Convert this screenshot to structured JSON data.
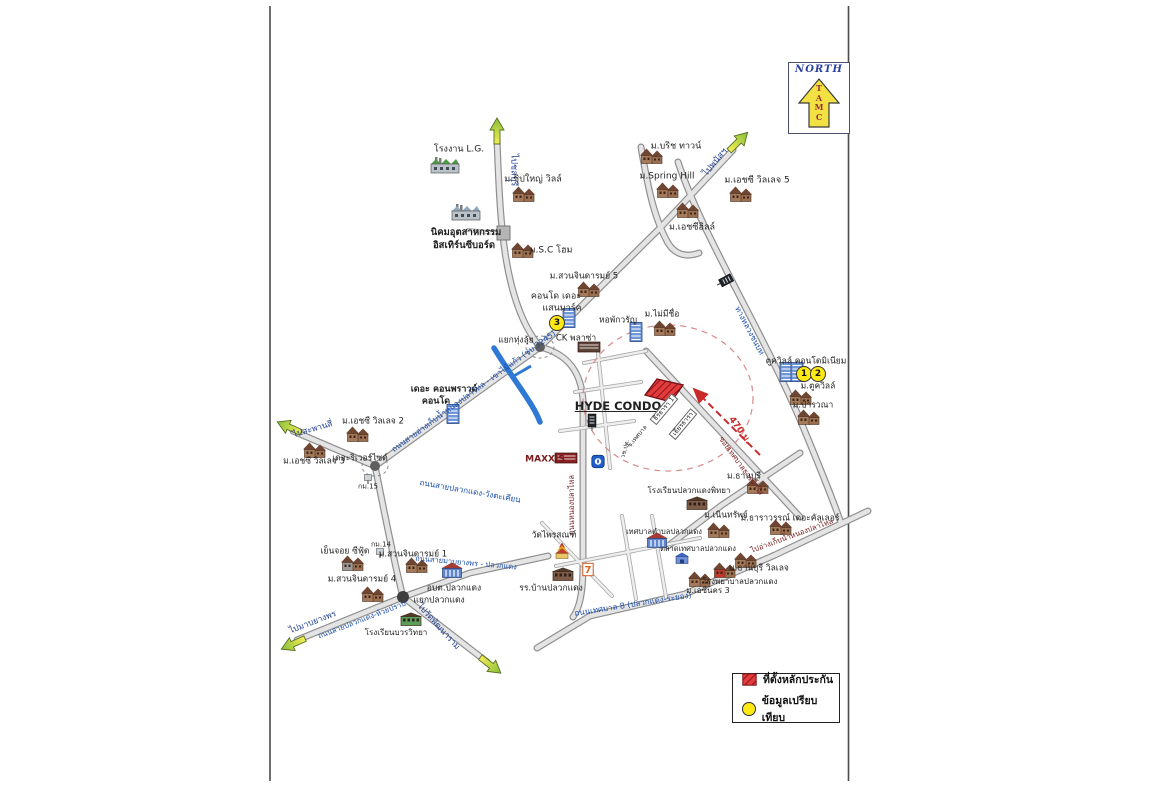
{
  "north_box": {
    "label": "NORTH",
    "letters": [
      "T",
      "A",
      "M",
      "C"
    ]
  },
  "legend": {
    "items": [
      {
        "key": "collateral-site",
        "label": "ที่ตั้งหลักประกัน"
      },
      {
        "key": "comparison-data",
        "label": "ข้อมูลเปรียบเทียบ"
      }
    ]
  },
  "colors": {
    "road_label_blue": "#1d4fae",
    "direction_navy": "#23418f",
    "distance_red": "#c92a2a",
    "soi_maroon": "#7a2020",
    "badge_yellow": "#ffe913",
    "site_hatch_red": "#e43b3b"
  },
  "map": {
    "site_name": "HYDE CONDO",
    "site_distance": "470 ม.",
    "labels": [
      {
        "text": "โรงงาน L.G.",
        "x": 459,
        "y": 150,
        "size": 9
      },
      {
        "text": "ไปชลบุรี",
        "x": 513,
        "y": 170,
        "rotate": 90,
        "color": "#23418f",
        "size": 9
      },
      {
        "text": "ม.ชิปใหญ่ วิลล์",
        "x": 533,
        "y": 180,
        "size": 9
      },
      {
        "text": "นิคมอุตสาหกรรม",
        "x": 466,
        "y": 233,
        "size": 9.5,
        "bold": true
      },
      {
        "text": "อิสเทิร์นซีบอร์ด",
        "x": 464,
        "y": 246,
        "size": 9.5,
        "bold": true
      },
      {
        "text": "ม.S.C โฮม",
        "x": 551,
        "y": 251,
        "size": 9
      },
      {
        "text": "ม.บริช ทาวน์",
        "x": 676,
        "y": 147,
        "size": 9
      },
      {
        "text": "ไปพนัสฯ",
        "x": 716,
        "y": 163,
        "rotate": -50,
        "color": "#23418f",
        "size": 9
      },
      {
        "text": "ม.Spring Hill",
        "x": 667,
        "y": 177,
        "size": 9
      },
      {
        "text": "ม.เอชซี วิลเลจ 5",
        "x": 757,
        "y": 181,
        "size": 9
      },
      {
        "text": "ม.เอชซีฮิลล์",
        "x": 692,
        "y": 228,
        "size": 9
      },
      {
        "text": "ม.สวนจินดารมย์ 5",
        "x": 584,
        "y": 277,
        "size": 8.5
      },
      {
        "text": "คอนโด เดอะ",
        "x": 556,
        "y": 297,
        "size": 9
      },
      {
        "text": "แสนมาร์ค",
        "x": 562,
        "y": 309,
        "size": 9
      },
      {
        "text": "แยกทุ่งลุ้ย",
        "x": 516,
        "y": 341,
        "size": 8.5
      },
      {
        "text": "CK พลาซ่า",
        "x": 576,
        "y": 339,
        "size": 8.5
      },
      {
        "text": "หอพักวรัญ",
        "x": 618,
        "y": 321,
        "size": 8.5
      },
      {
        "text": "ม.ไม่มีชื่อ",
        "x": 662,
        "y": 315,
        "size": 8.5
      },
      {
        "text": "ตูควิลล์ คอนโดมิเนียม",
        "x": 806,
        "y": 362,
        "size": 8.5
      },
      {
        "text": "ม.ตูควิลล์",
        "x": 818,
        "y": 387,
        "size": 8.5
      },
      {
        "text": "ม.ปารวณา",
        "x": 813,
        "y": 406,
        "size": 8.5
      },
      {
        "text": "HYDE CONDO",
        "x": 618,
        "y": 406,
        "size": 11.5,
        "bold": true,
        "underline": true
      },
      {
        "text": "470 ม.",
        "x": 739,
        "y": 431,
        "rotate": 54,
        "color": "#c92a2a",
        "size": 9,
        "bold": true
      },
      {
        "text": "ซอยเทศบาลธารน้ำใส",
        "x": 741,
        "y": 466,
        "rotate": 54,
        "color": "#7a2020",
        "size": 7.5
      },
      {
        "text": "ธีรธารา 1",
        "x": 664,
        "y": 409,
        "rotate": -50,
        "size": 6.5,
        "kind": "plot"
      },
      {
        "text": "เธียรธารา",
        "x": 683,
        "y": 424,
        "rotate": -50,
        "size": 6.5,
        "kind": "plot"
      },
      {
        "text": "ซ.เทศบาล",
        "x": 638,
        "y": 437,
        "rotate": -50,
        "size": 6
      },
      {
        "text": "วช.ปด.",
        "x": 626,
        "y": 449,
        "rotate": -75,
        "size": 6
      },
      {
        "text": "เดอะ คอนพราวด์",
        "x": 444,
        "y": 390,
        "size": 9,
        "bold": true
      },
      {
        "text": "คอนโด",
        "x": 436,
        "y": 402,
        "size": 9,
        "bold": true
      },
      {
        "text": "ถนนสายอ่างเก็บน้ำหนองปลาไหล - เขาไม้แก้ว (ชบ.3245)",
        "x": 474,
        "y": 392,
        "rotate": -36,
        "color": "#1d4fae",
        "size": 8
      },
      {
        "text": "ถนนสายปลวกแดง-วังตะเคียน",
        "x": 470,
        "y": 492,
        "rotate": 10,
        "color": "#1d4fae",
        "size": 8
      },
      {
        "text": "MAXXIS",
        "x": 545,
        "y": 460,
        "size": 9,
        "bold": true,
        "color": "#7a1a1a"
      },
      {
        "text": "ถนนหนองปลาไหล",
        "x": 572,
        "y": 505,
        "rotate": -90,
        "color": "#7a2020",
        "size": 7.5
      },
      {
        "text": "ไปสะพานสี่",
        "x": 313,
        "y": 430,
        "rotate": -16,
        "color": "#23418f",
        "size": 8.5
      },
      {
        "text": "ม.เอชซี วิลเลจ 2",
        "x": 373,
        "y": 422,
        "size": 8.5
      },
      {
        "text": "ม.เอชซี วิลเลจ 3",
        "x": 314,
        "y": 462,
        "size": 8.5
      },
      {
        "text": "เดอะริเวอร์ไซด์",
        "x": 360,
        "y": 459,
        "size": 8.5
      },
      {
        "text": "กม.15",
        "x": 368,
        "y": 487,
        "size": 7
      },
      {
        "text": "เย็นจอย ซีฟู้ด",
        "x": 345,
        "y": 552,
        "size": 8.5
      },
      {
        "text": "กม.14",
        "x": 381,
        "y": 545,
        "size": 7
      },
      {
        "text": "ม.สวนจินดารมย์ 1",
        "x": 413,
        "y": 555,
        "size": 8.5
      },
      {
        "text": "ม.สวนจินดารมย์ 4",
        "x": 362,
        "y": 580,
        "size": 8.5
      },
      {
        "text": "อบต.ปลวกแดง",
        "x": 454,
        "y": 589,
        "size": 8.5
      },
      {
        "text": "แยกปลวกแดง",
        "x": 439,
        "y": 601,
        "size": 8.5
      },
      {
        "text": "ถนนสายมาบยางพร - ปลวกแดง",
        "x": 466,
        "y": 563,
        "rotate": 5,
        "color": "#1d4fae",
        "size": 7.5
      },
      {
        "text": "ไปมาบยางพร",
        "x": 313,
        "y": 623,
        "rotate": -21,
        "color": "#23418f",
        "size": 8.5
      },
      {
        "text": "ถนนสายปลวกแดง-ห้วยปราบ",
        "x": 362,
        "y": 620,
        "rotate": -21,
        "color": "#1d4fae",
        "size": 7.5
      },
      {
        "text": "ไปวัดพัฒนาราม",
        "x": 438,
        "y": 627,
        "rotate": 48,
        "color": "#23418f",
        "size": 8.5
      },
      {
        "text": "โรงเรียนบวรวิทยา",
        "x": 396,
        "y": 633,
        "size": 8
      },
      {
        "text": "วัดไพรสณฑ์",
        "x": 554,
        "y": 536,
        "size": 8.5
      },
      {
        "text": "รร.บ้านปลวกแดง",
        "x": 551,
        "y": 589,
        "size": 8.5
      },
      {
        "text": "ถนนเทศบาล 8 (ปลวกแดง-ระยอง)",
        "x": 633,
        "y": 605,
        "rotate": -9,
        "color": "#1d4fae",
        "size": 8
      },
      {
        "text": "เทศบาลตำบลปลวกแดง",
        "x": 664,
        "y": 532,
        "size": 7.5
      },
      {
        "text": "ตลาดเทศบาลปลวกแดง",
        "x": 698,
        "y": 549,
        "size": 7.5
      },
      {
        "text": "โรงเรียนปลวกแดงพิทยา",
        "x": 689,
        "y": 491,
        "size": 8
      },
      {
        "text": "ม.เนินทรัพย์",
        "x": 726,
        "y": 516,
        "size": 8.5
      },
      {
        "text": "ม.ธานบุรี",
        "x": 744,
        "y": 477,
        "size": 8.5
      },
      {
        "text": "ม.ธาราวรรณ์ เดอะคัลเลอร์",
        "x": 790,
        "y": 519,
        "size": 8.5
      },
      {
        "text": "ม.ธานบุรี วิลเลจ",
        "x": 759,
        "y": 569,
        "size": 8.5
      },
      {
        "text": "โรงพยาบาลปลวกแดง",
        "x": 740,
        "y": 582,
        "size": 8
      },
      {
        "text": "ม.เอซีนคร 3",
        "x": 708,
        "y": 591,
        "size": 8
      },
      {
        "text": "ไปอ่างเก็บน้ำหนองปลาไหล",
        "x": 792,
        "y": 536,
        "rotate": -20,
        "color": "#7a2020",
        "size": 7.5
      },
      {
        "text": "ทางหลวงชนบท",
        "x": 749,
        "y": 331,
        "rotate": 62,
        "color": "#1d4fae",
        "size": 8
      }
    ],
    "badges": [
      {
        "n": "3",
        "x": 557,
        "y": 323
      },
      {
        "n": "1",
        "x": 804,
        "y": 374
      },
      {
        "n": "2",
        "x": 818,
        "y": 374
      }
    ],
    "buildings": [
      {
        "type": "factory",
        "name": "lg-factory",
        "x": 445,
        "y": 167,
        "tint": "#4e9a46"
      },
      {
        "type": "house",
        "x": 524,
        "y": 196
      },
      {
        "type": "factory",
        "name": "eastern-seaboard-industrial-estate",
        "x": 466,
        "y": 214,
        "tint": "#8fa9bd"
      },
      {
        "type": "house",
        "x": 523,
        "y": 252
      },
      {
        "type": "house",
        "x": 652,
        "y": 158
      },
      {
        "type": "house",
        "x": 668,
        "y": 192
      },
      {
        "type": "house",
        "x": 741,
        "y": 196
      },
      {
        "type": "house",
        "x": 688,
        "y": 212
      },
      {
        "type": "house",
        "x": 589,
        "y": 291
      },
      {
        "type": "condo",
        "name": "saen-mark-condo",
        "x": 569,
        "y": 320
      },
      {
        "type": "shop",
        "name": "ck-plaza-shop",
        "x": 589,
        "y": 348,
        "tint": "#5a4638"
      },
      {
        "type": "condo",
        "name": "waran-dormitory",
        "x": 636,
        "y": 334
      },
      {
        "type": "house",
        "x": 665,
        "y": 330
      },
      {
        "type": "condo",
        "x": 786,
        "y": 374
      },
      {
        "type": "condo",
        "x": 797,
        "y": 374
      },
      {
        "type": "house",
        "x": 801,
        "y": 399
      },
      {
        "type": "house",
        "x": 809,
        "y": 419
      },
      {
        "type": "condo",
        "name": "compound-condo",
        "x": 453,
        "y": 416
      },
      {
        "type": "house",
        "x": 358,
        "y": 436
      },
      {
        "type": "house",
        "x": 315,
        "y": 452
      },
      {
        "type": "house",
        "x": 417,
        "y": 567
      },
      {
        "type": "house",
        "x": 373,
        "y": 596
      },
      {
        "type": "house",
        "name": "yenjoy-seafood",
        "x": 353,
        "y": 565,
        "tint": "#9a9a9a"
      },
      {
        "type": "civic",
        "name": "obt-pluakdaeng-office",
        "x": 452,
        "y": 572
      },
      {
        "type": "school",
        "name": "bowon-school",
        "x": 411,
        "y": 621,
        "tint": "#5a9e5a"
      },
      {
        "type": "temple",
        "name": "wat-phraison-temple",
        "x": 562,
        "y": 553
      },
      {
        "type": "school",
        "name": "ban-pluakdaeng-school",
        "x": 563,
        "y": 576
      },
      {
        "type": "seven",
        "name": "seven-eleven",
        "x": 588,
        "y": 571
      },
      {
        "type": "civic",
        "name": "tessaban-office",
        "x": 657,
        "y": 542
      },
      {
        "type": "market",
        "name": "municipal-market",
        "x": 682,
        "y": 560
      },
      {
        "type": "school",
        "name": "pluakdaeng-pittaya-school",
        "x": 697,
        "y": 505
      },
      {
        "type": "house",
        "x": 719,
        "y": 532
      },
      {
        "type": "house",
        "x": 758,
        "y": 488
      },
      {
        "type": "house",
        "x": 781,
        "y": 529
      },
      {
        "type": "house",
        "x": 746,
        "y": 562
      },
      {
        "type": "house",
        "name": "thanburi-village-red",
        "x": 725,
        "y": 572,
        "tint": "#c0392b"
      },
      {
        "type": "house",
        "x": 700,
        "y": 581
      },
      {
        "type": "shop",
        "name": "maxxis-shop",
        "x": 566,
        "y": 459,
        "tint": "#8a2020"
      },
      {
        "type": "ptt",
        "name": "ptt-station",
        "x": 598,
        "y": 463
      },
      {
        "type": "sign",
        "x": 592,
        "y": 424
      },
      {
        "type": "sign",
        "x": 723,
        "y": 282,
        "rotate": 62
      },
      {
        "type": "km",
        "x": 368,
        "y": 479
      },
      {
        "type": "km",
        "x": 380,
        "y": 553
      }
    ]
  }
}
